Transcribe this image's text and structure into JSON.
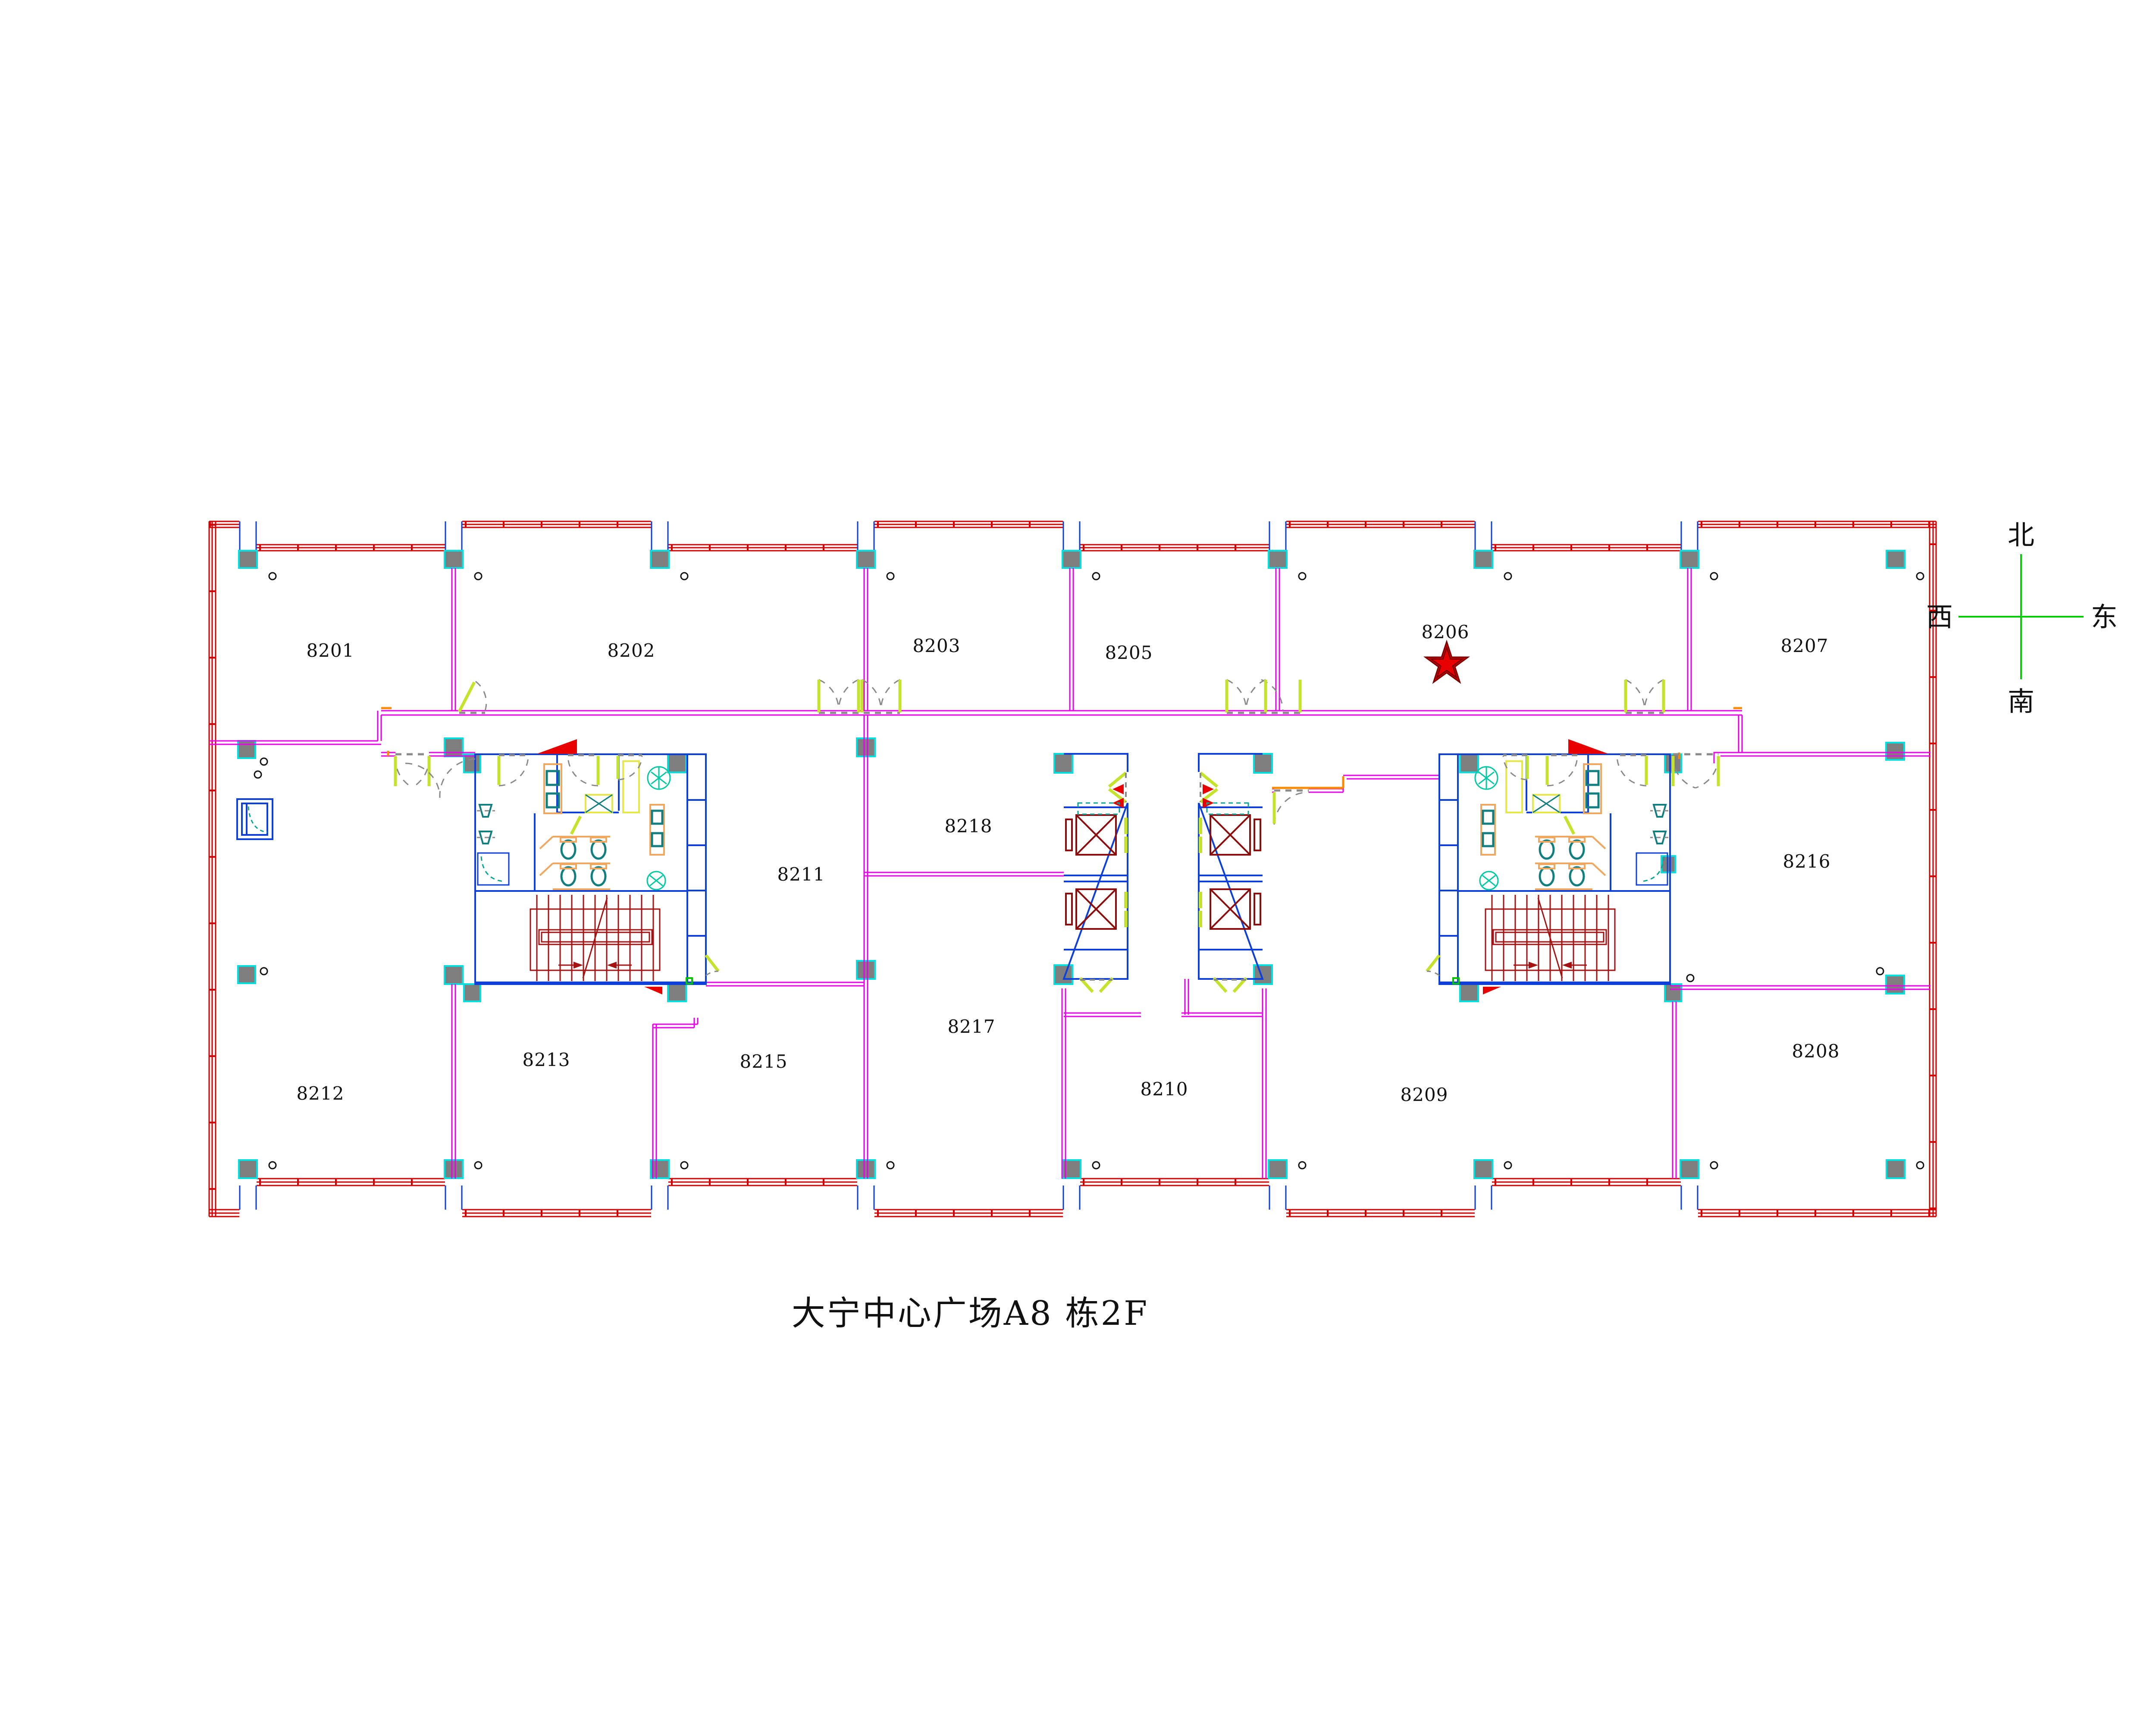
{
  "title": "大宁中心广场A8 栋2F",
  "compass": {
    "north": "北",
    "south": "南",
    "east": "东",
    "west": "西"
  },
  "rooms": [
    {
      "number": "8201"
    },
    {
      "number": "8202"
    },
    {
      "number": "8203"
    },
    {
      "number": "8205"
    },
    {
      "number": "8206"
    },
    {
      "number": "8207"
    },
    {
      "number": "8211"
    },
    {
      "number": "8218"
    },
    {
      "number": "8216"
    },
    {
      "number": "8212"
    },
    {
      "number": "8213"
    },
    {
      "number": "8215"
    },
    {
      "number": "8217"
    },
    {
      "number": "8210"
    },
    {
      "number": "8209"
    },
    {
      "number": "8208"
    }
  ],
  "marker": {
    "type": "red-star",
    "room": "8206",
    "color": "#e60000"
  },
  "palette": {
    "facade_red": "#d40000",
    "partition_magenta": "#e800e8",
    "core_blue": "#0d3fd9",
    "stair_red": "#a51212",
    "elevator_red": "#8b0e0e",
    "door_green": "#c3e32d",
    "column_gray": "#7e7e7e",
    "column_cyan": "#00e0e0",
    "fixture_teal": "#117f7f",
    "plant_teal": "#00c9a3",
    "accent_orange": "#ff8a00",
    "compass_green": "#00cc00"
  }
}
